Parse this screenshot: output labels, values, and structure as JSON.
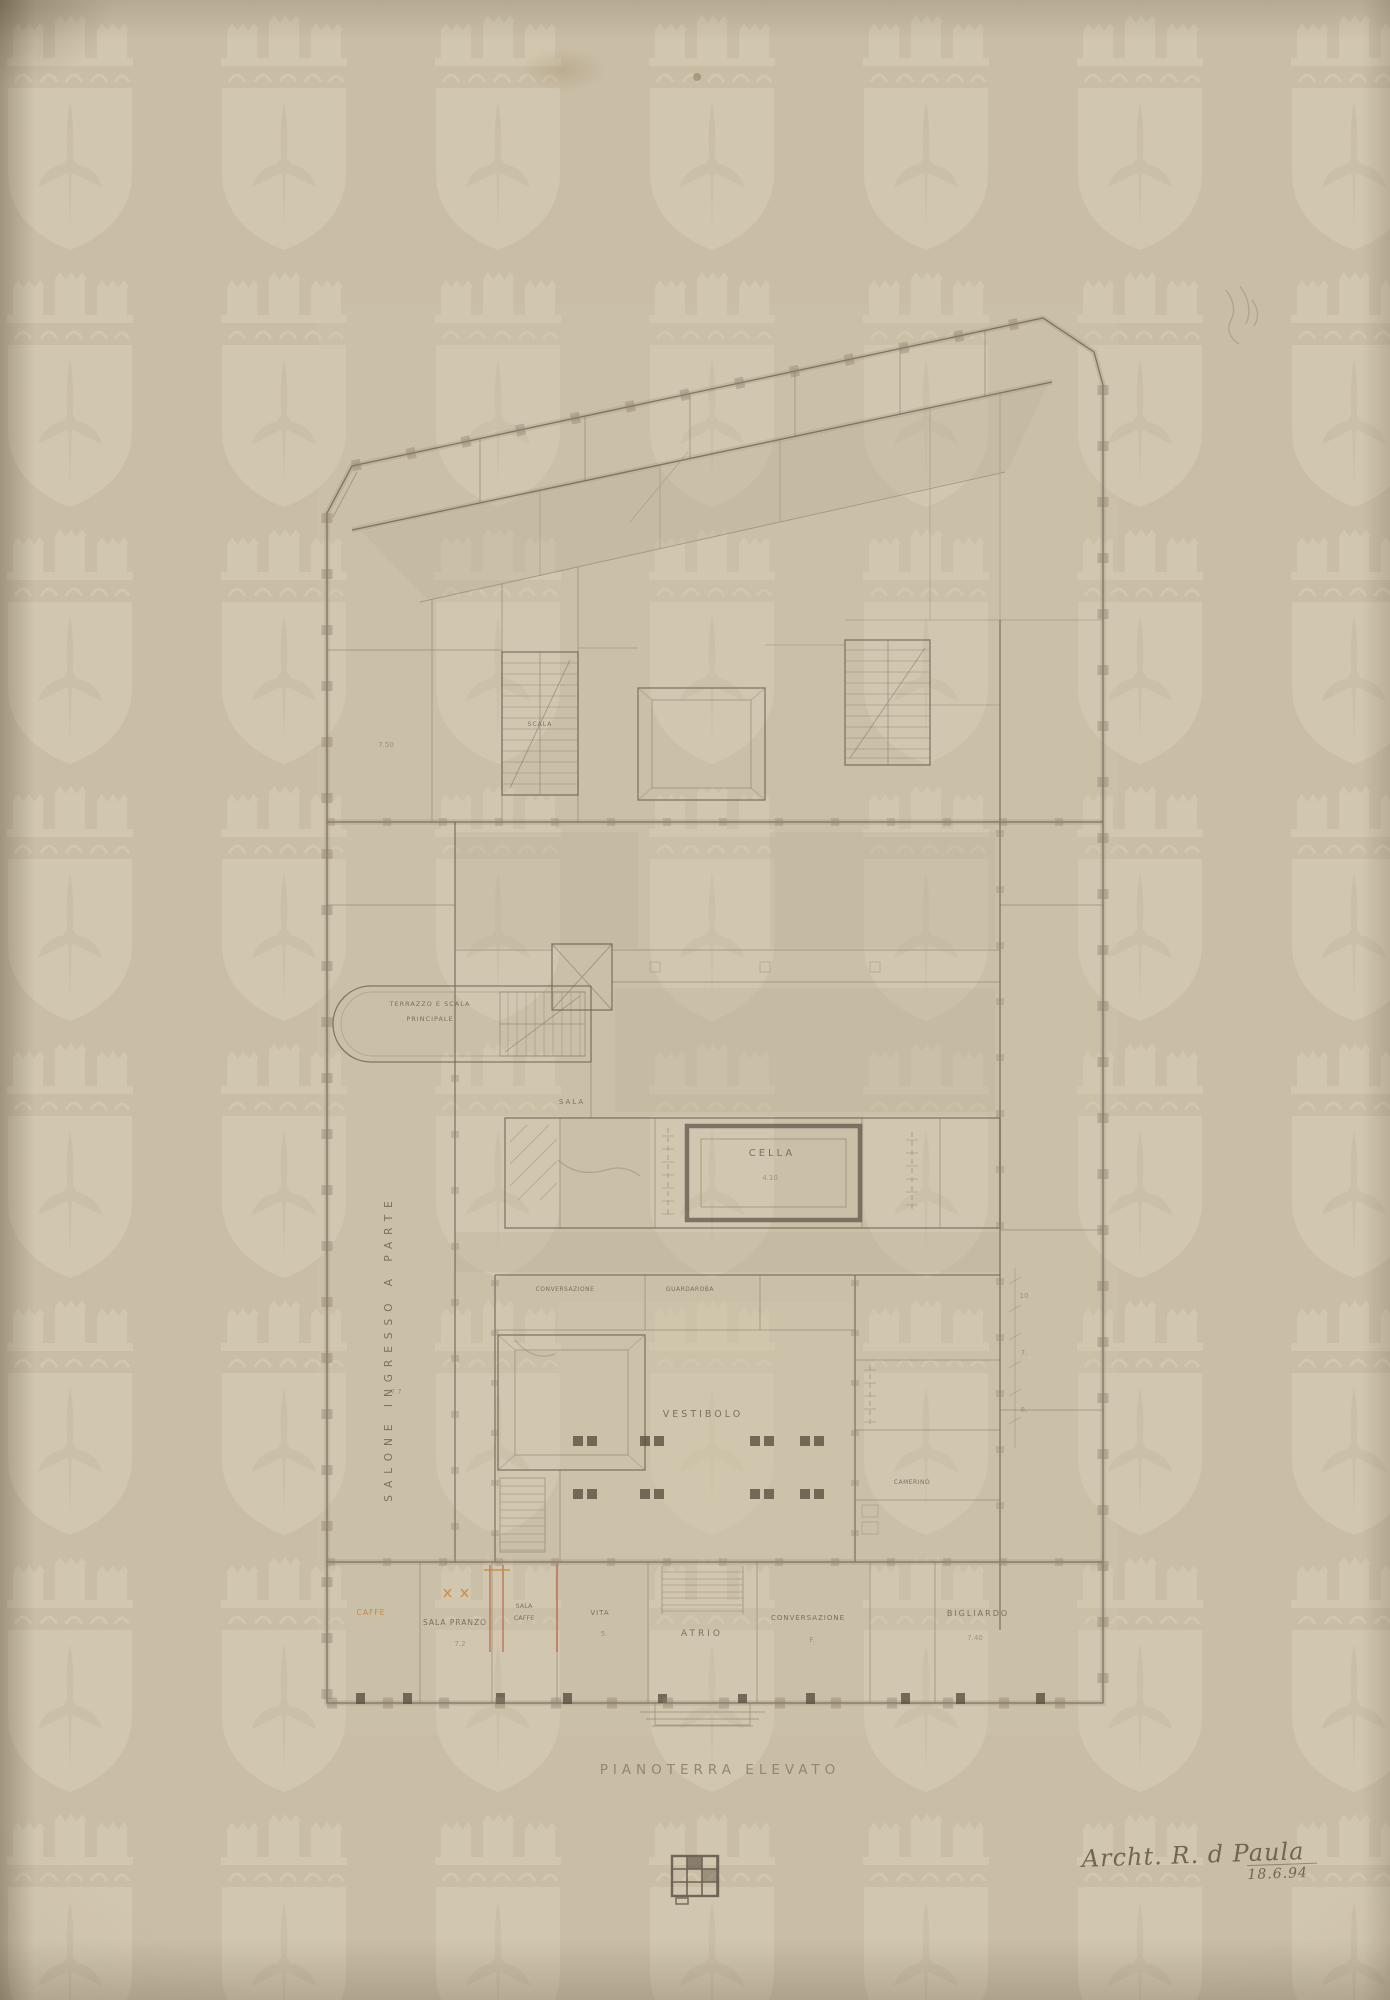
{
  "page": {
    "background": "#c9bda6",
    "ink": "#6e6354",
    "wall": "#8a7e6b",
    "wash_green": "#b6b098",
    "accent_red": "#b3502e",
    "accent_orange": "#c8842d",
    "watermark_tone": "#dbd1bb"
  },
  "watermark": {
    "symbol": "crowned-castle-shield-fleur-de-lis-watermark",
    "cols": 7,
    "rows": 8,
    "spacing_x": 214,
    "spacing_y": 257,
    "origin_x": -5,
    "origin_y": 14
  },
  "caption": {
    "text": "PIANOTERRA ELEVATO"
  },
  "signature": {
    "line1": "Archt. R. d Paula",
    "line2": "18.6.94"
  },
  "stamp": {
    "glyph": "monogram-grid-stamp"
  },
  "plan": {
    "labels": {
      "cella": "CELLA",
      "cella_dim": "4.10",
      "vestibolo": "VESTIBOLO",
      "atrio": "ATRIO",
      "bigliardo": "BIGLIARDO",
      "bigliardo_dim": "7.40",
      "conversazione_bottom": "CONVERSAZIONE",
      "conversazione_bottom_dim": "F.",
      "sala_pranzo": "SALA PRANZO",
      "sala_pranzo_dim": "7.2",
      "sala_caffe_1": "SALA",
      "sala_caffe_2": "CAFFE",
      "vita": "VITA",
      "vita_dim": "5.",
      "caffe_orange": "CAFFE",
      "conversazione_top": "CONVERSAZIONE",
      "guardaroba": "GUARDAROBA",
      "sala_mid": "SALA",
      "scala": "SCALA",
      "camerino": "CAMERINO",
      "terrazzo_line1": "TERRAZZO E SCALA",
      "terrazzo_line2": "PRINCIPALE",
      "salone_vertical": "SALONE INGRESSO A PARTE",
      "dim_7_50": "7.50",
      "dim_7_7": "7.7",
      "dim_tick_1": "10",
      "dim_tick_2": "7.",
      "dim_tick_3": "8."
    }
  }
}
